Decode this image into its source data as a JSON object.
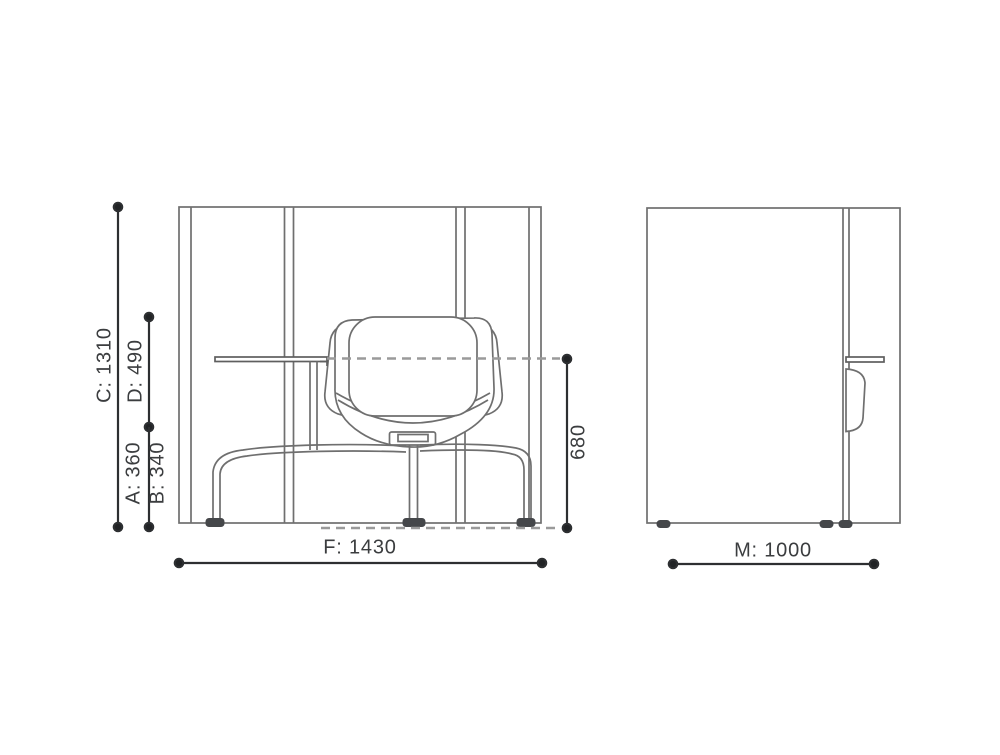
{
  "page": {
    "background": "#ffffff",
    "description": "Technical dimension drawing: acoustic work pod with lounge chair and tablet table, front and side elevations"
  },
  "colors": {
    "drawing_line": "#6f6f6f",
    "dimension_line": "#2d2f31",
    "dimension_dot": "#212325",
    "dashed_reference_line": "#9a9a9a",
    "label_text": "#3b3d3f",
    "foot_fill": "#45474a"
  },
  "dimensions": {
    "C": {
      "label": "C: 1310",
      "value": 1310,
      "axis": "vertical"
    },
    "D": {
      "label": "D: 490",
      "value": 490,
      "axis": "vertical"
    },
    "A": {
      "label": "A: 360",
      "value": 360,
      "axis": "vertical"
    },
    "B": {
      "label": "B: 340",
      "value": 340,
      "axis": "vertical"
    },
    "seat_back_height": {
      "label": "680",
      "value": 680,
      "axis": "vertical"
    },
    "F": {
      "label": "F: 1430",
      "value": 1430,
      "axis": "horizontal"
    },
    "M": {
      "label": "M: 1000",
      "value": 1000,
      "axis": "horizontal"
    }
  }
}
